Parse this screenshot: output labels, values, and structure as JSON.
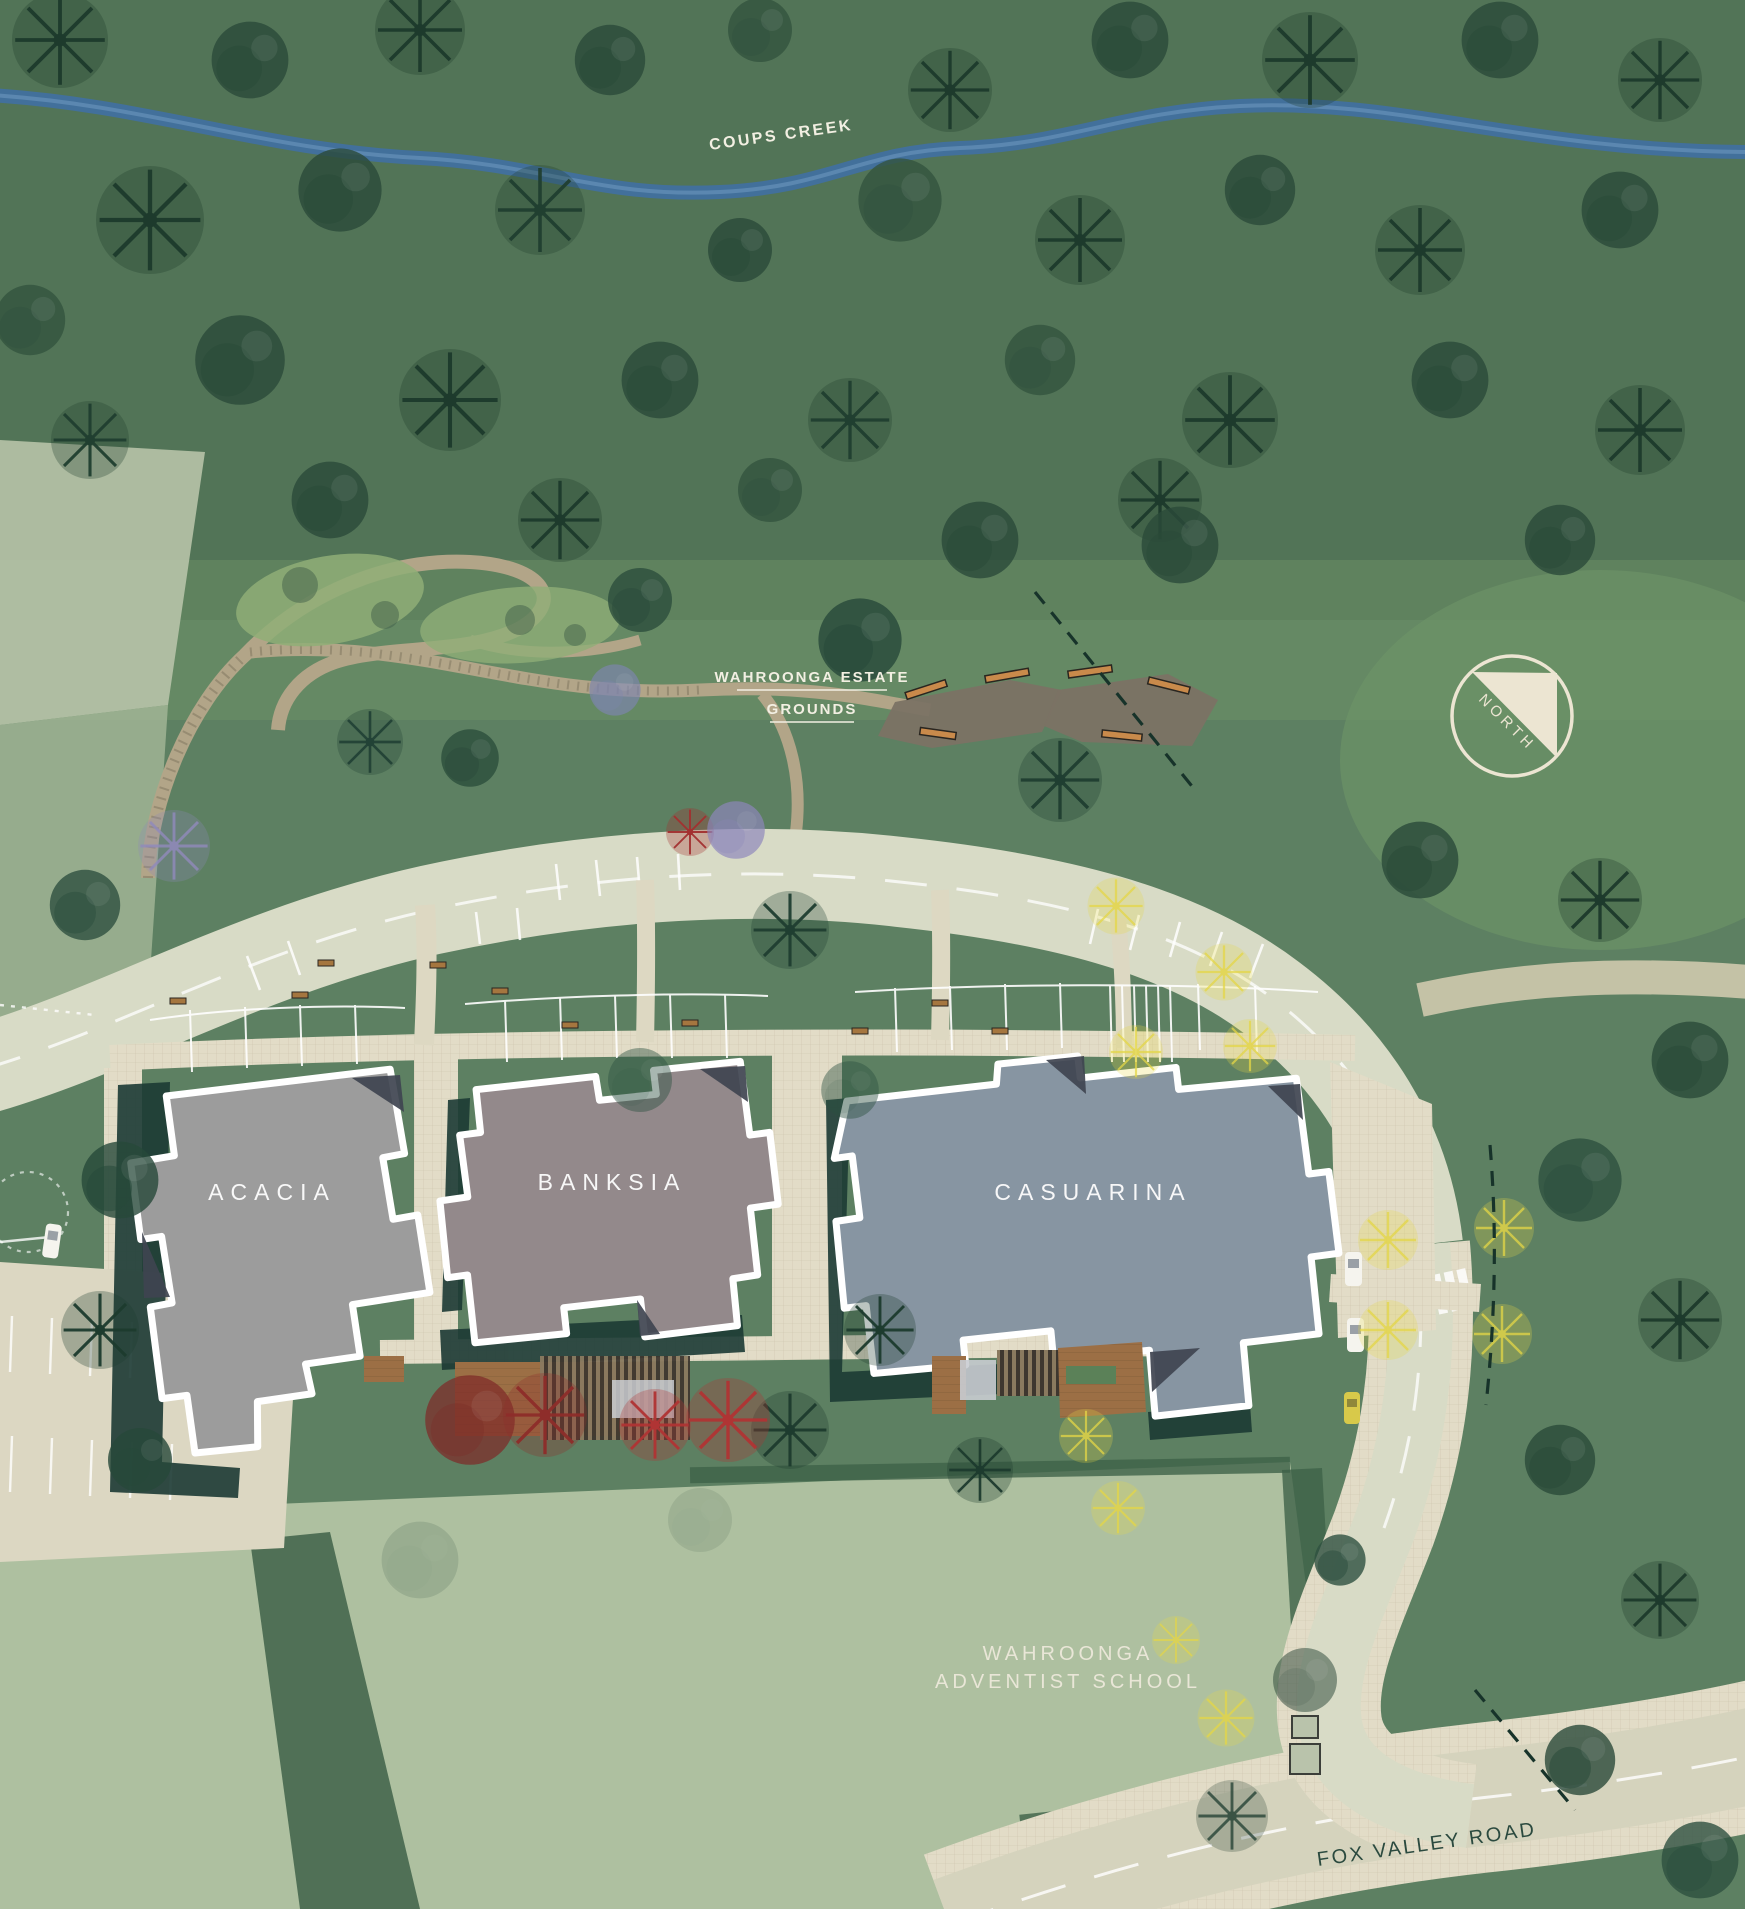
{
  "title": "Wahroonga Estate site plan",
  "labels": {
    "creek": "COUPS CREEK",
    "estate_line1": "WAHROONGA ESTATE",
    "estate_line2": "GROUNDS",
    "north": "NORTH",
    "school_line1": "WAHROONGA",
    "school_line2": "ADVENTIST SCHOOL",
    "road": "FOX VALLEY ROAD"
  },
  "buildings": [
    {
      "name": "ACACIA",
      "color": "#9c9c9c"
    },
    {
      "name": "BANKSIA",
      "color": "#93898b"
    },
    {
      "name": "CASUARINA",
      "color": "#8795a2"
    }
  ],
  "colors": {
    "grass": "#5d8062",
    "forest": "#527457",
    "field": "#aec0a0",
    "creek": "#41709f",
    "road": "#d8dbc6",
    "plaza": "#e2dcc7",
    "trail": "#b2a588",
    "stone": "#7b7264",
    "deck_timber": "#9c6f45",
    "shadow_teal": "#1c3a34",
    "roof_dark": "#3f4450",
    "accent_red": "#993030",
    "accent_yellow": "#e4d647",
    "accent_purple": "#9089bb",
    "label_light": "#f2efe2",
    "label_dark": "#2b4a3f",
    "compass_cream": "#ece5d2"
  }
}
